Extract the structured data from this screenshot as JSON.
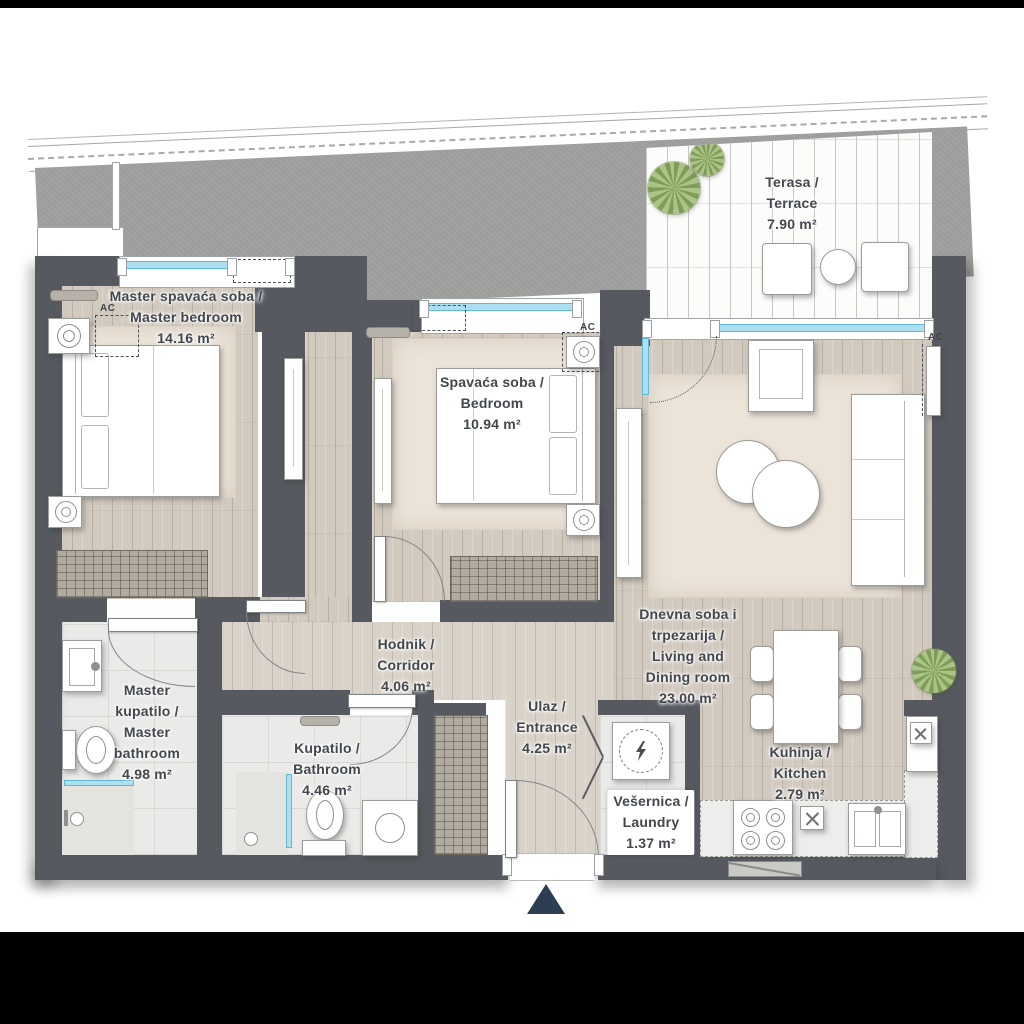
{
  "rooms": [
    {
      "id": "master-bedroom",
      "lines": [
        "Master spavaća soba /",
        "Master bedroom"
      ],
      "area": "14.16 m²"
    },
    {
      "id": "bedroom",
      "lines": [
        "Spavaća soba /",
        "Bedroom"
      ],
      "area": "10.94 m²"
    },
    {
      "id": "terrace",
      "lines": [
        "Terasa /",
        "Terrace"
      ],
      "area": "7.90 m²"
    },
    {
      "id": "living-dining",
      "lines": [
        "Dnevna soba i",
        "trpezarija /",
        "Living and",
        "Dining room"
      ],
      "area": "23.00 m²"
    },
    {
      "id": "corridor",
      "lines": [
        "Hodnik /",
        "Corridor"
      ],
      "area": "4.06 m²"
    },
    {
      "id": "master-bathroom",
      "lines": [
        "Master",
        "kupatilo /",
        "Master",
        "bathroom"
      ],
      "area": "4.98 m²"
    },
    {
      "id": "bathroom",
      "lines": [
        "Kupatilo /",
        "Bathroom"
      ],
      "area": "4.46 m²"
    },
    {
      "id": "entrance",
      "lines": [
        "Ulaz /",
        "Entrance"
      ],
      "area": "4.25 m²"
    },
    {
      "id": "laundry",
      "lines": [
        "Vešernica /",
        "Laundry"
      ],
      "area": "1.37 m²"
    },
    {
      "id": "kitchen",
      "lines": [
        "Kuhinja /",
        "Kitchen"
      ],
      "area": "2.79 m²"
    }
  ],
  "labels": {
    "ac": "AC"
  },
  "colors": {
    "wall": "#565a60",
    "glass": "#ace0f0",
    "wood": "#d2cabf",
    "tile": "#eaeae8",
    "terrace": "#fcfcfb",
    "entrance_marker": "#2e3e52",
    "exterior": "#9c9c9a"
  }
}
